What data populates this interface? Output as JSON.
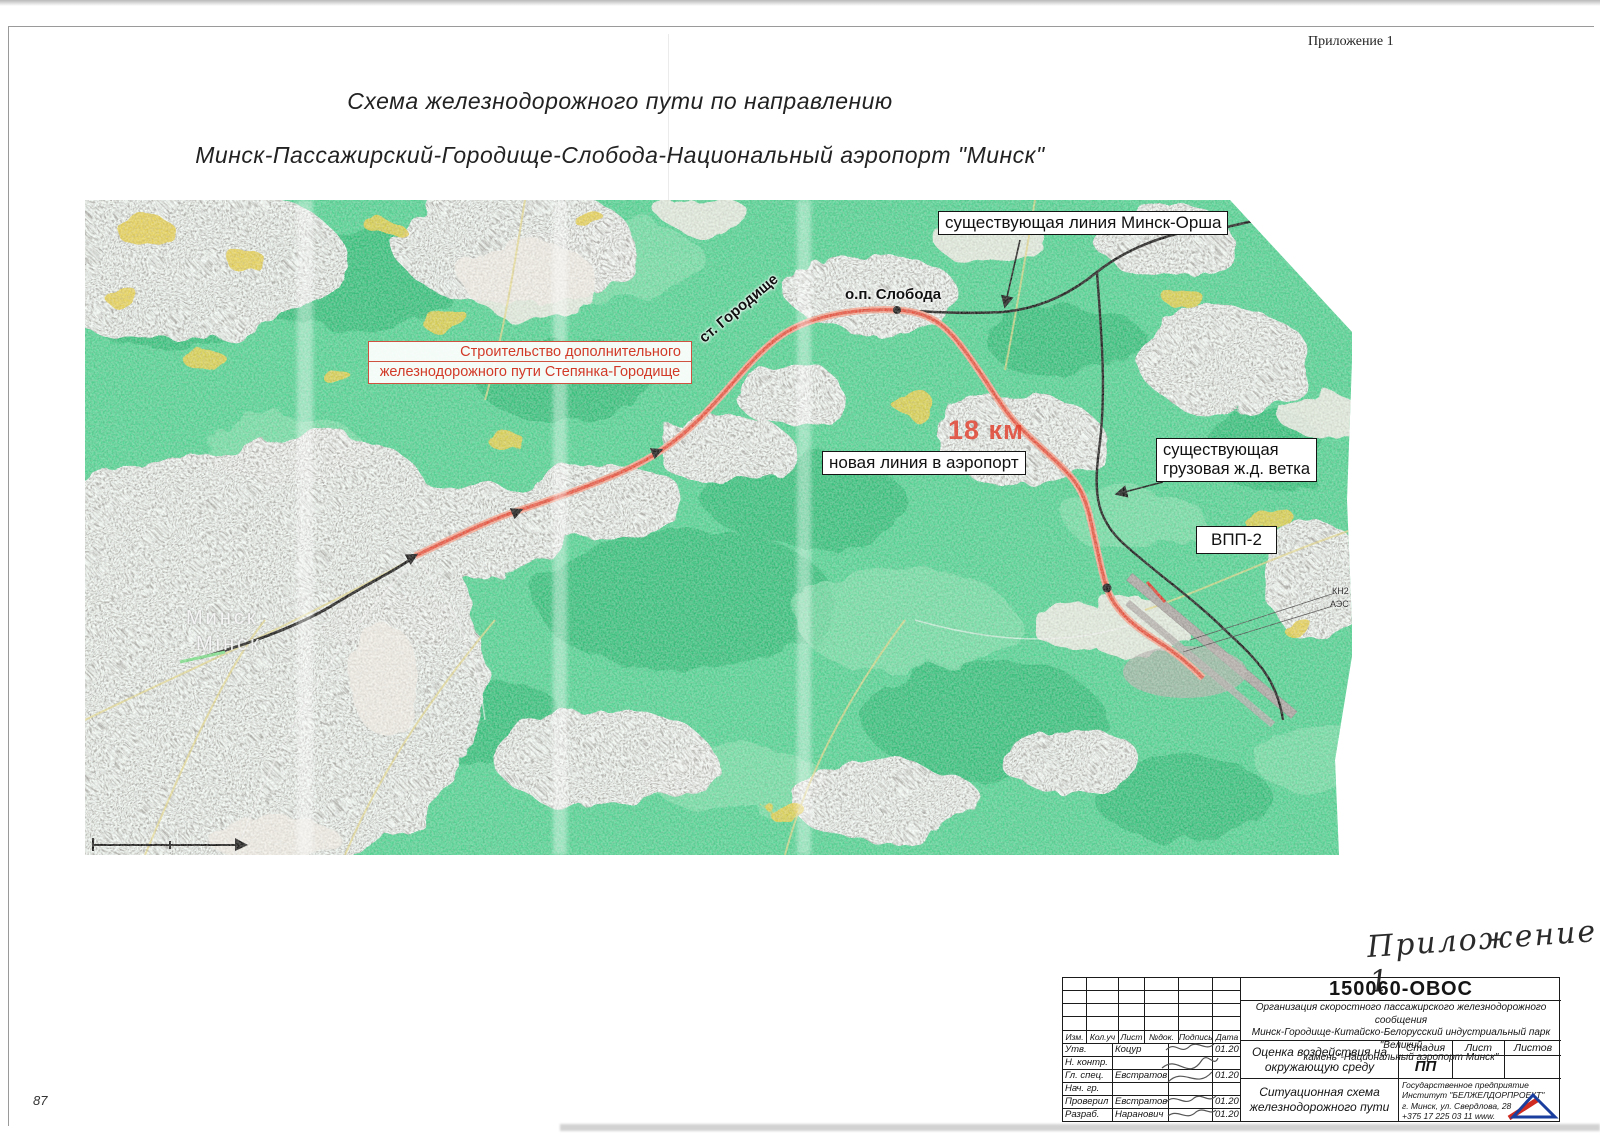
{
  "page": {
    "corner_note": "Приложение 1",
    "page_number": "87",
    "title_line1": "Схема железнодорожного пути по направлению",
    "title_line2": "Минск-Пассажирский-Городище-Слобода-Национальный аэропорт \"Минск\""
  },
  "map": {
    "labels": {
      "existing_line": "существующая линия Минск-Орша",
      "sloboda_stop": "о.п. Слобода",
      "construction_line1": "Строительство дополнительного",
      "construction_line2": "железнодорожного пути Степянка-Городище",
      "gorodishche_station": "ст. Городище",
      "distance": "18 км",
      "new_line": "новая линия в аэропорт",
      "freight_line1": "существующая",
      "freight_line2": "грузовая ж.д. ветка",
      "runway": "ВПП-2",
      "kn2": "КН2",
      "aes": "АЭС",
      "minsk_ru": "Минск",
      "minsk_be": "Мінск"
    },
    "colors": {
      "forest": "#4fd492",
      "urban": "#b3abaa",
      "field_yellow": "#e7d04c",
      "new_rail_red": "#e8503c",
      "existing_rail_black": "#161616"
    }
  },
  "stamp": {
    "handwritten_note": "Приложение 1",
    "doc_number": "150060-ОВОС",
    "project_line1": "Организация скоростного пассажирского железнодорожного сообщения",
    "project_line2": "Минск-Городище-Китайско-Белорусский индустриальный парк \"Великий",
    "project_line3": "камень\"-Национальный аэропорт  Минск\"",
    "doc_title_line1": "Оценка воздействия на",
    "doc_title_line2": "окружающую среду",
    "sheet_title_line1": "Ситуационная схема",
    "sheet_title_line2": "железнодорожного пути",
    "stage_header": "Стадия",
    "sheet_header": "Лист",
    "sheets_header": "Листов",
    "stage_value": "ПП",
    "rev_headers": [
      "Изм.",
      "Кол.уч",
      "Лист",
      "№док.",
      "Подпись",
      "Дата"
    ],
    "roles": [
      {
        "role": "Утв.",
        "name": "Коцур",
        "date": "01.20"
      },
      {
        "role": "Н. контр.",
        "name": "",
        "date": ""
      },
      {
        "role": "Гл. спец.",
        "name": "Евстратов",
        "date": "01.20"
      },
      {
        "role": "Нач. гр.",
        "name": "",
        "date": ""
      },
      {
        "role": "Проверил",
        "name": "Евстратов",
        "date": "01.20"
      },
      {
        "role": "Разраб.",
        "name": "Наранович",
        "date": "01.20"
      }
    ],
    "org_line1": "Государственное предприятие",
    "org_line2": "Институт \"БЕЛЖЕЛДОРПРОЕКТ\"",
    "org_line3": "г. Минск, ул. Свердлова, 28",
    "org_line4": "+375 17 225 03 11   www."
  }
}
